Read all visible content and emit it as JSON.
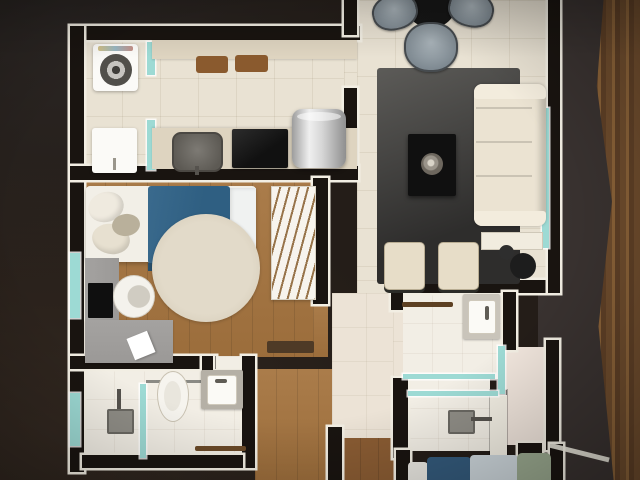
{
  "scene": {
    "title": "Apartment floor plan photo",
    "setting": "printed 3D top-down floor plan photographed on a dark wooden table",
    "visible_text": ""
  },
  "colors": {
    "bg": "#241d18",
    "card": "#393230",
    "woodTable": "#6e4c2d",
    "woodTableLight": "#8a6238",
    "paper": "#f2eee3",
    "wall": "#191410",
    "tile": "#e9e2d3",
    "tileHall": "#ece3d6",
    "bath": "#f2eee5",
    "pink": "#f0e5dc",
    "woodFloor": "#a5743f",
    "woodDark": "#8a5c33",
    "glass": "#9ddad4",
    "rugDark": "#2e2d2c",
    "rugLight": "#5c5b58",
    "counter": "#ded4c0",
    "board": "#8a5a2e",
    "blanket": "#2f5f82",
    "blanketDark": "#274f6b",
    "bed2blue": "#33597a",
    "bed2light": "#ccd5da",
    "pillowGreen": "#9aa98f",
    "sofa": "#ebe3d2",
    "cream": "#e7ddc8",
    "desk": "#9b9997",
    "tv": "#0f0f0f",
    "vanity": "#b5b0a6",
    "towel": "#6b4a28",
    "towel2": "#5d4022",
    "chairGray": "#7d8890",
    "tableBlack": "#161616",
    "drum": "#514f4a"
  },
  "rooms": [
    {
      "name": "laundry",
      "items": [
        "washing-machine",
        "laundry-sink",
        "glass-partition"
      ]
    },
    {
      "name": "kitchen",
      "items": [
        "counter",
        "cutting-boards",
        "kitchen-sink",
        "cooktop",
        "steel-cylinder-appliance"
      ]
    },
    {
      "name": "living-dining-room",
      "items": [
        "round-dining-table",
        "dining-chairs",
        "area-rug",
        "coffee-table",
        "ornament",
        "sofa",
        "armchairs",
        "plant",
        "console-table",
        "window"
      ]
    },
    {
      "name": "bedroom-1",
      "items": [
        "double-bed",
        "pillows",
        "blue-blanket",
        "round-rug",
        "open-wardrobe",
        "bench",
        "desk",
        "tv",
        "chair",
        "window"
      ]
    },
    {
      "name": "bathroom-1",
      "items": [
        "shower",
        "glass-screen",
        "toilet",
        "vanity-sink",
        "towel-bar",
        "window"
      ]
    },
    {
      "name": "bathroom-2",
      "items": [
        "vanity-sink",
        "towel-bar",
        "glass-shower",
        "shower-head",
        "partition"
      ]
    },
    {
      "name": "hallway",
      "items": []
    },
    {
      "name": "bedroom-2",
      "items": [
        "bed",
        "blue-blanket",
        "green-pillow"
      ]
    }
  ]
}
